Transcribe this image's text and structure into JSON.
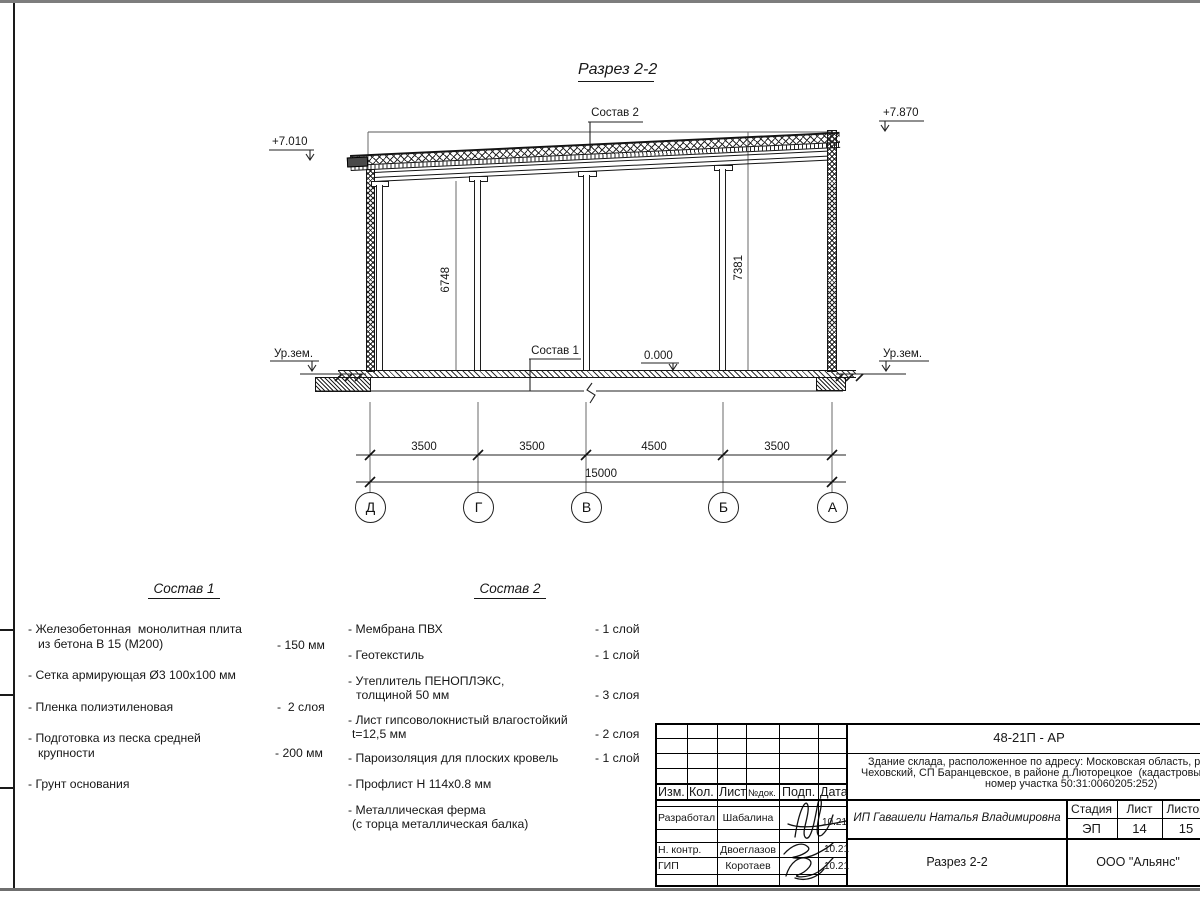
{
  "drawing": {
    "title": "Разрез 2-2",
    "callouts": {
      "sostav1": "Состав 1",
      "sostav2": "Состав 2"
    },
    "elevations": {
      "left": "+7.010",
      "right": "+7.870",
      "zero": "0.000"
    },
    "ground": {
      "left": "Ур.зем.",
      "right": "Ур.зем."
    },
    "heights": {
      "left": "6748",
      "right": "7381"
    },
    "dimensions": {
      "segments": [
        "3500",
        "3500",
        "4500",
        "3500"
      ],
      "total": "15000"
    },
    "axes": [
      "Д",
      "Г",
      "В",
      "Б",
      "А"
    ]
  },
  "sostav1": {
    "title": "Состав 1",
    "items": [
      {
        "line1": "- Железобетонная  монолитная плита",
        "line2": "из бетона В 15 (М200)",
        "value": "- 150 мм"
      },
      {
        "line1": "- Сетка армирующая Ø3 100х100 мм",
        "line2": "",
        "value": ""
      },
      {
        "line1": "- Пленка полиэтиленовая",
        "line2": "",
        "value": "-  2 слоя"
      },
      {
        "line1": "- Подготовка из песка средней",
        "line2": "крупности",
        "value": "- 200 мм"
      },
      {
        "line1": "- Грунт основания",
        "line2": "",
        "value": ""
      }
    ]
  },
  "sostav2": {
    "title": "Состав 2",
    "items": [
      {
        "line1": "- Мембрана ПВХ",
        "line2": "",
        "value": "- 1 слой"
      },
      {
        "line1": "- Геотекстиль",
        "line2": "",
        "value": "- 1 слой"
      },
      {
        "line1": "- Утеплитель ПЕНОПЛЭКС,",
        "line2": "толщиной 50 мм",
        "value": "- 3 слоя"
      },
      {
        "line1": "- Лист гипсоволокнистый влагостойкий",
        "line2": "t=12,5 мм",
        "value": "- 2 слоя"
      },
      {
        "line1": "- Пароизоляция для плоских кровель",
        "line2": "",
        "value": "- 1 слой"
      },
      {
        "line1": "- Профлист Н 114х0.8 мм",
        "line2": "",
        "value": ""
      },
      {
        "line1": "- Металлическая ферма",
        "line2": "(с торца металлическая балка)",
        "value": ""
      }
    ]
  },
  "titleblock": {
    "doc_number": "48-21П - АР",
    "description": {
      "line1": "Здание склада, расположенное по адресу: Московская область, р",
      "line2": "Чеховский, СП Баранцевское, в районе д.Люторецкое  (кадастровы",
      "line3": "номер участка 50:31:0060205:252)"
    },
    "header": {
      "izm": "Изм.",
      "kol": "Кол.",
      "list": "Лист",
      "ndok": "№док.",
      "podp": "Подп.",
      "data": "Дата"
    },
    "rows": [
      {
        "role": "Разработал",
        "name": "Шабалина",
        "date": "10.21"
      },
      {
        "role": "Н. контр.",
        "name": "Двоеглазов",
        "date": "10.21"
      },
      {
        "role": "ГИП",
        "name": "Коротаев",
        "date": "10.21"
      }
    ],
    "customer": "ИП Гавашели Наталья Владимировна",
    "stage_label": "Стадия",
    "sheet_label": "Лист",
    "sheets_label": "Листов",
    "stage_value": "ЭП",
    "sheet_value": "14",
    "sheets_value": "15",
    "sheet_name": "Разрез 2-2",
    "company": "ООО \"Альянс\""
  }
}
